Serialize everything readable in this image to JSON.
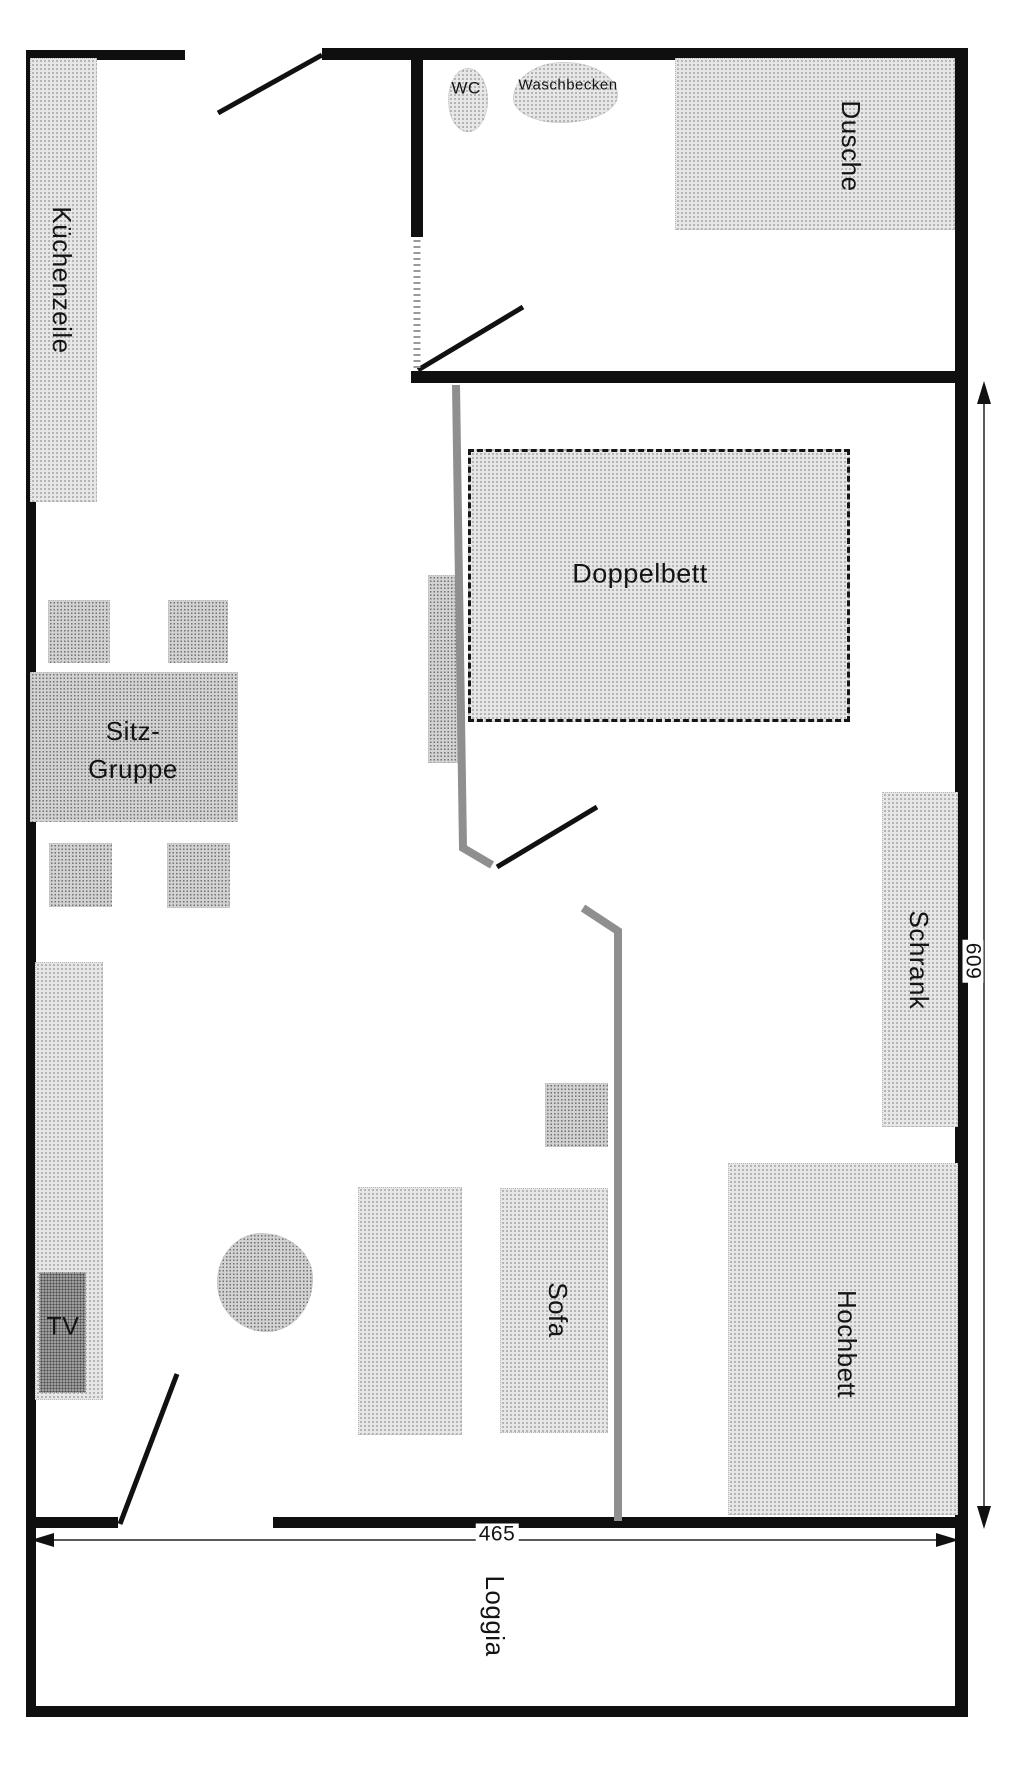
{
  "meta": {
    "type": "apartment floor plan",
    "language": "German"
  },
  "rooms": {
    "bathroom": {
      "toilet_label": "WC",
      "washbasin_label": "Waschbecken",
      "shower_label": "Dusche"
    },
    "main_room": {
      "kitchen_label": "Küchenzeile",
      "double_bed_label": "Doppelbett",
      "seating_label_line1": "Sitz-",
      "seating_label_line2": "Gruppe",
      "wardrobe_label": "Schrank",
      "sofa_label": "Sofa",
      "loft_bed_label": "Hochbett",
      "tv_label": "TV"
    },
    "balcony": {
      "loggia_label": "Loggia"
    }
  },
  "dimensions": {
    "vertical_cm": "609",
    "horizontal_cm": "465"
  },
  "colors": {
    "wall": "#0f0f0f",
    "furniture_light": "#e7e7e7",
    "furniture_mid": "#d2d2d2",
    "tv_dark": "#9d9d9d",
    "partition_gray": "#8f8f8f",
    "bed_dash_border": "#151515",
    "text": "#141414"
  }
}
